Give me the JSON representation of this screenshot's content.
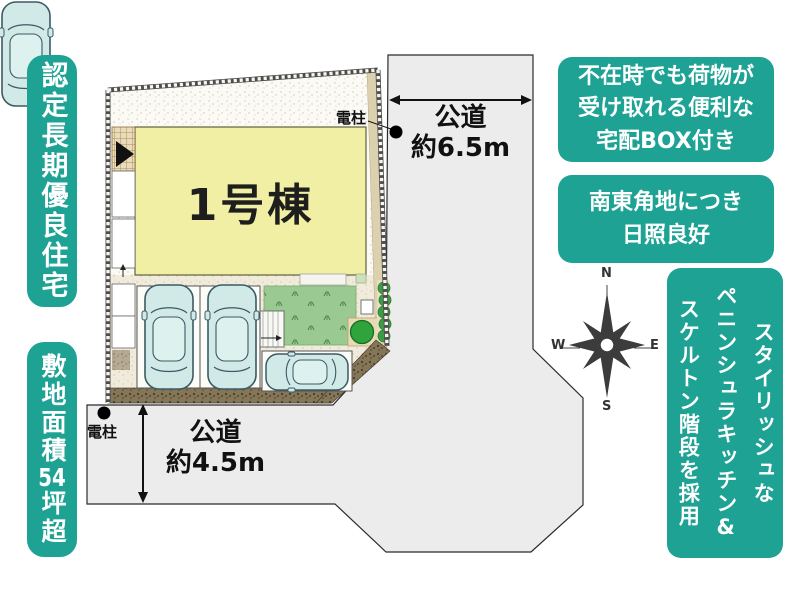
{
  "colors": {
    "teal": "#1da294",
    "road_gray": "#ececec",
    "building_yellow": "#f1efa3",
    "lawn_green": "#9ac991",
    "car_body": "#d2eae7",
    "paving_brown": "#857657",
    "text_dark": "#1c1c1c"
  },
  "left_banners": {
    "top": "認定長期優良住宅",
    "bottom": {
      "p1": "敷地面積",
      "p2": "54",
      "p3": "坪超"
    }
  },
  "plan": {
    "building_label": "1号棟",
    "road_right": {
      "label": "公道",
      "width": "約6.5m"
    },
    "road_bottom": {
      "label": "公道",
      "width": "約4.5m"
    },
    "pole_top": "電柱",
    "pole_bottom": "電柱"
  },
  "feature_boxes": {
    "delivery": "不在時でも荷物が\n受け取れる便利な\n宅配BOX付き",
    "corner": "南東角地につき\n日照良好",
    "interior": "スタイリッシュな\nペニンシュラキッチン&\nスケルトン階段を採用"
  },
  "compass": {
    "n": "N",
    "e": "E",
    "s": "S",
    "w": "W"
  }
}
